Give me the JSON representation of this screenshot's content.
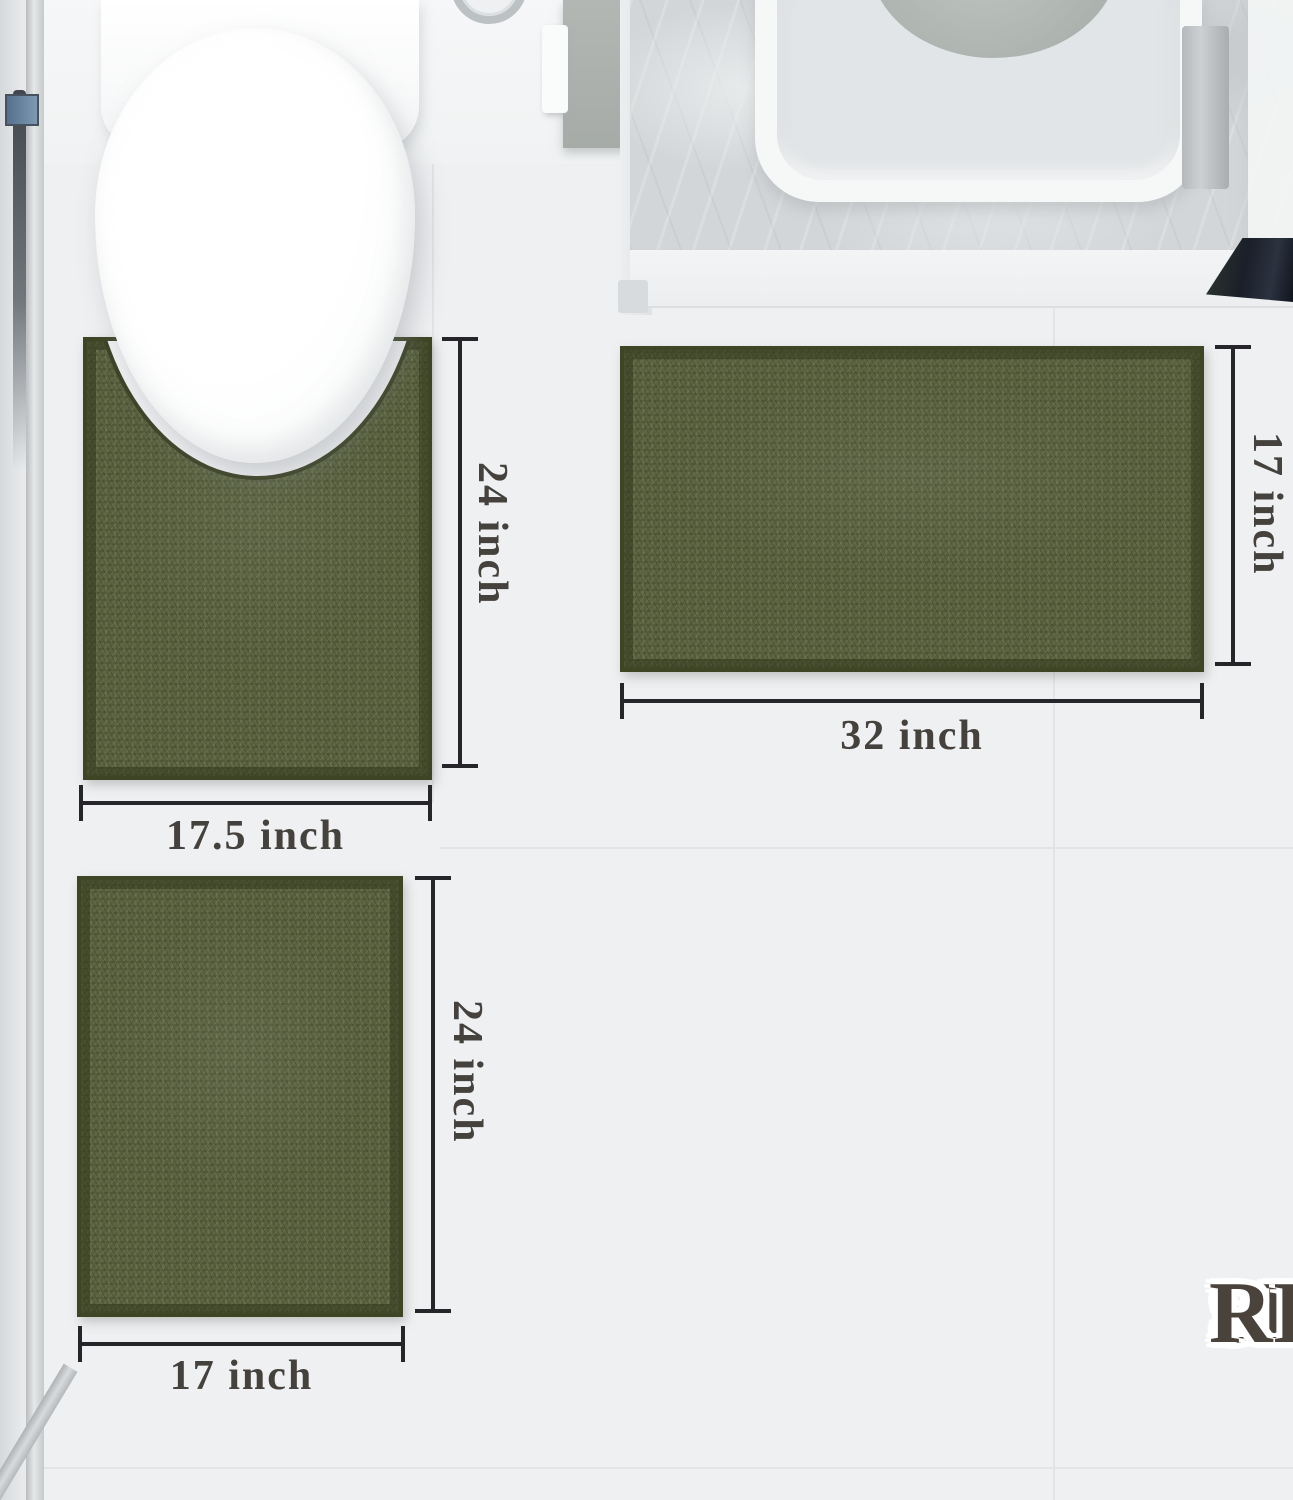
{
  "title": {
    "line1": "SIZE",
    "line2": "REFERENCE"
  },
  "rugs": {
    "contour": {
      "height_label": "24 inch",
      "width_label": "17.5 inch"
    },
    "large": {
      "height_label": "17 inch",
      "width_label": "32 inch"
    },
    "small": {
      "height_label": "24 inch",
      "width_label": "17 inch"
    }
  },
  "colors": {
    "rug_green": "#59613f",
    "rug_border": "#3e4525",
    "dimension_line": "#26262a",
    "dimension_text": "#45413d",
    "title_text": "#4a433c",
    "floor": "#eff0f2",
    "marble_counter": "#d3d6d8",
    "door_mat": "#1a1f29"
  }
}
